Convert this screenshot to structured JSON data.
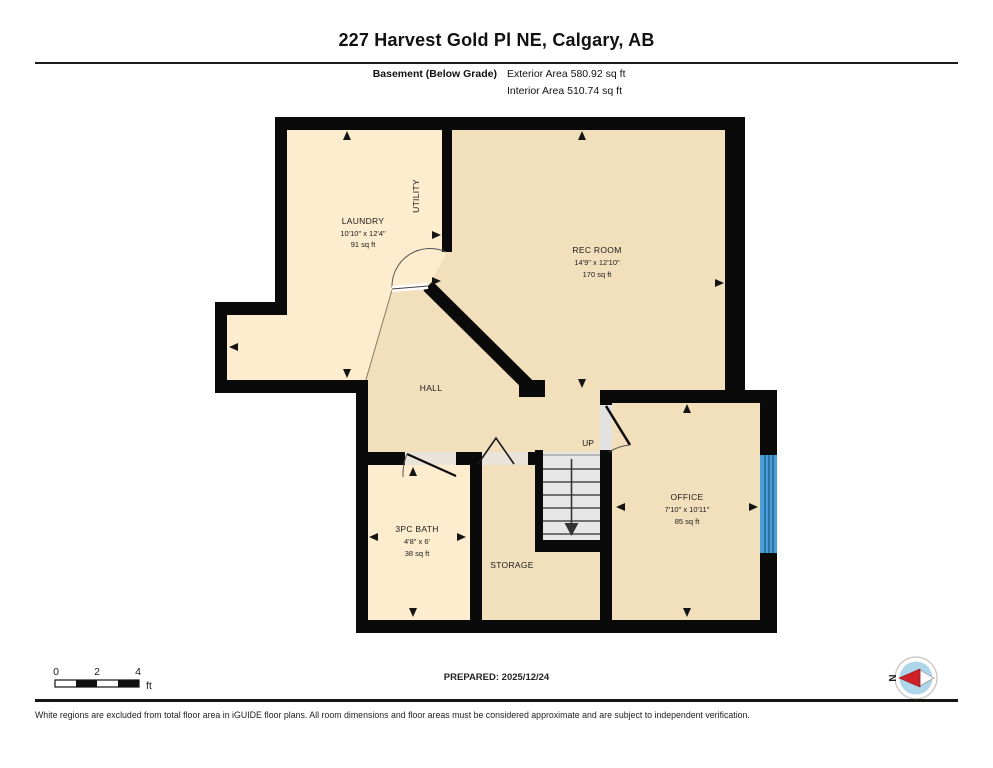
{
  "header": {
    "title": "227 Harvest Gold Pl NE, Calgary, AB",
    "floor_label": "Basement (Below Grade)",
    "exterior_area": "Exterior Area 580.92 sq ft",
    "interior_area": "Interior Area 510.74 sq ft"
  },
  "plan": {
    "rooms": [
      {
        "name": "LAUNDRY",
        "dims": "10'10\" x 12'4\"",
        "area": "91 sq ft"
      },
      {
        "name": "UTILITY"
      },
      {
        "name": "REC ROOM",
        "dims": "14'9\" x 12'10\"",
        "area": "170 sq ft"
      },
      {
        "name": "HALL"
      },
      {
        "name": "UP"
      },
      {
        "name": "3PC BATH",
        "dims": "4'8\" x 6'",
        "area": "38 sq ft"
      },
      {
        "name": "STORAGE"
      },
      {
        "name": "OFFICE",
        "dims": "7'10\" x 10'11\"",
        "area": "85 sq ft"
      }
    ],
    "colors": {
      "room_light": "#fdeccd",
      "room_dark": "#f2e0bd",
      "stairs": "#e7e7e7",
      "wall": "#0a0a0a",
      "window": "#4a9fd8"
    }
  },
  "footer": {
    "scale": {
      "ticks": [
        "0",
        "2",
        "4"
      ],
      "unit": "ft"
    },
    "prepared": "PREPARED: 2025/12/24",
    "compass_label": "N",
    "disclaimer": "White regions are excluded from total floor area in iGUIDE floor plans. All room dimensions and floor areas must be considered approximate and are subject to independent verification."
  }
}
